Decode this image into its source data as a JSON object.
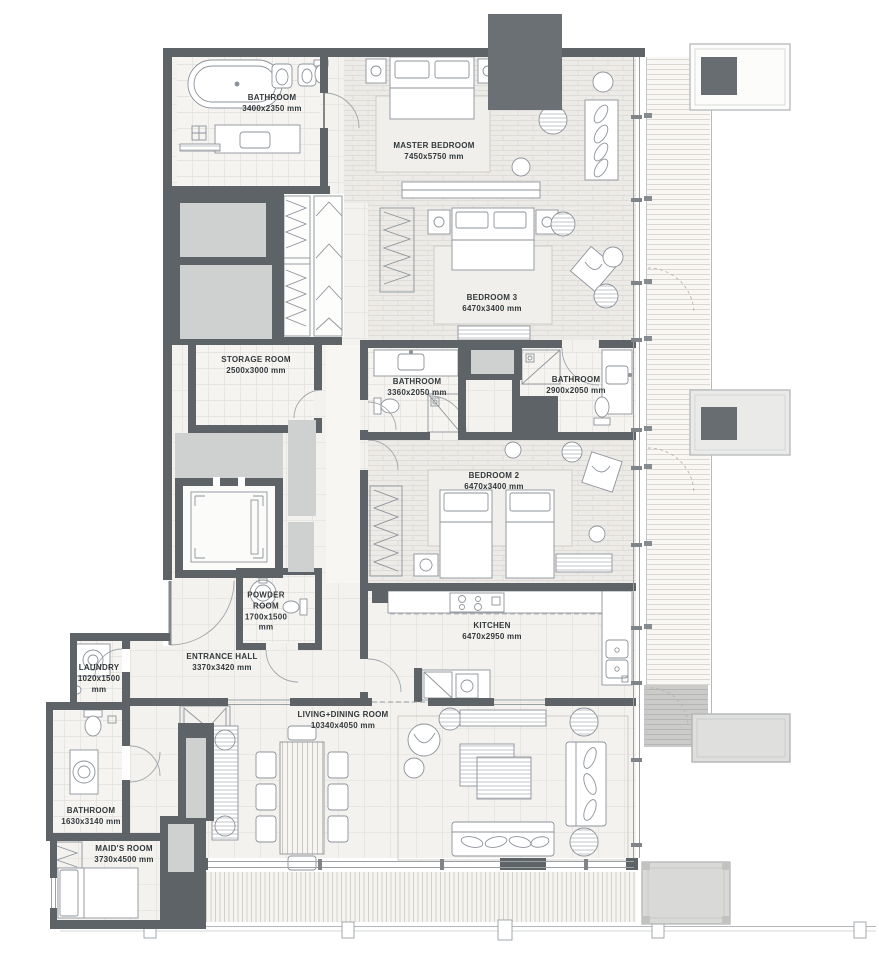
{
  "plan": {
    "type": "apartment-floor-plan",
    "rooms": [
      {
        "id": "bathroom-master",
        "name": "BATHROOM",
        "dims": "3400x2350 mm"
      },
      {
        "id": "master-bedroom",
        "name": "MASTER BEDROOM",
        "dims": "7450x5750 mm"
      },
      {
        "id": "bedroom-3",
        "name": "BEDROOM 3",
        "dims": "6470x3400 mm"
      },
      {
        "id": "storage-room",
        "name": "STORAGE ROOM",
        "dims": "2500x3000 mm"
      },
      {
        "id": "bathroom-3",
        "name": "BATHROOM",
        "dims": "3360x2050 mm"
      },
      {
        "id": "bathroom-2",
        "name": "BATHROOM",
        "dims": "2900x2050 mm"
      },
      {
        "id": "bedroom-2",
        "name": "BEDROOM 2",
        "dims": "6470x3400 mm"
      },
      {
        "id": "kitchen",
        "name": "KITCHEN",
        "dims": "6470x2950 mm"
      },
      {
        "id": "powder-room",
        "name": "POWDER ROOM",
        "dims": "1700x1500 mm"
      },
      {
        "id": "entrance-hall",
        "name": "ENTRANCE HALL",
        "dims": "3370x3420 mm"
      },
      {
        "id": "living-dining-room",
        "name": "LIVING+DINING ROOM",
        "dims": "10340x4050 mm"
      },
      {
        "id": "laundry",
        "name": "LAUNDRY",
        "dims": "1020x1500 mm"
      },
      {
        "id": "bathroom-maids",
        "name": "BATHROOM",
        "dims": "1630x3140 mm"
      },
      {
        "id": "maids-room",
        "name": "MAID'S ROOM",
        "dims": "3730x4500 mm"
      }
    ],
    "colors": {
      "wall": "#5d6367",
      "column": "#6a7074",
      "service_gray": "#cfd1d0",
      "floor_light": "#f3f2ef",
      "floor_brick": "#edebe7",
      "text": "#33383b"
    }
  }
}
